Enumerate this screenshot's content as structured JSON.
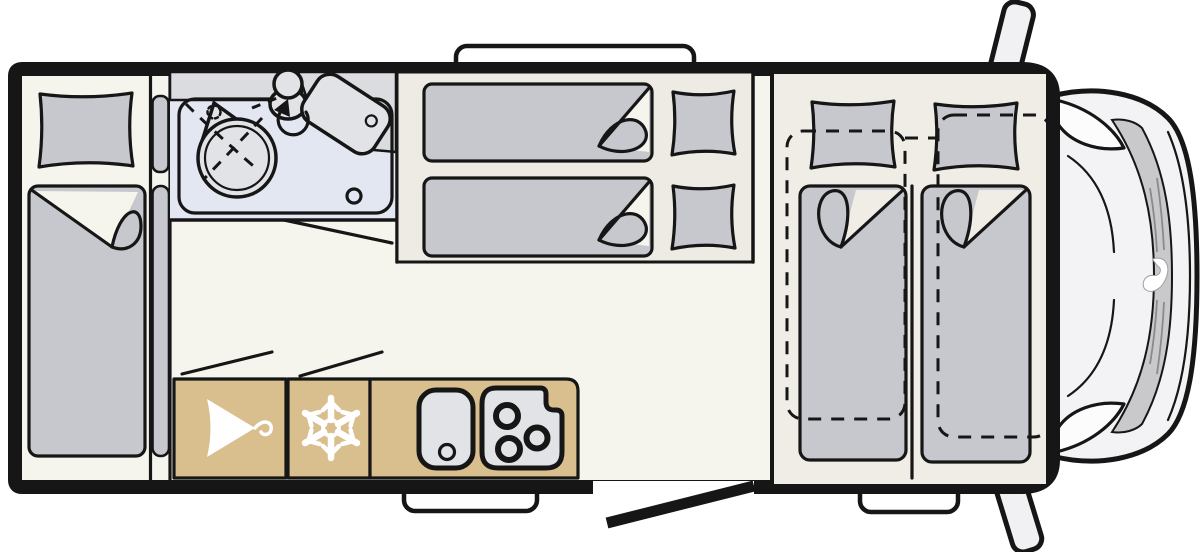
{
  "page": {
    "title": "Motorhome floor plan, top view",
    "background": "#ffffff"
  },
  "colors": {
    "outline": "#161616",
    "wall": "#161616",
    "floor": "#f5f4ed",
    "platform": "#edebe3",
    "bedroom_floor": "#efede5",
    "mattress": "#c6c8cd",
    "bathroom_floor": "#e3e7f2",
    "fixture": "#e2e3e6",
    "counter_gray": "#dbdcdf",
    "cabinet_tan": "#d9be8e",
    "icon": "#ffffff",
    "cab_body": "#f3f3f5",
    "hood_band": "#c9c9cc",
    "vent": "#8a8a8e",
    "mirror": "#f1f1f3"
  },
  "areas": [
    {
      "id": "rear-bedroom",
      "name": "rear bed with pillow and folded duvet"
    },
    {
      "id": "bathroom",
      "name": "washroom with shower, washbasin and toilet"
    },
    {
      "id": "middle-bedroom",
      "name": "two transverse single beds"
    },
    {
      "id": "kitchen",
      "name": "wardrobe, refrigerator and kitchen block"
    },
    {
      "id": "front-bedroom",
      "name": "two lengthwise single beds with dashed extension outline"
    },
    {
      "id": "cab",
      "name": "driver cab with mirrors"
    }
  ],
  "icons": [
    {
      "name": "hanger-icon",
      "meaning": "wardrobe"
    },
    {
      "name": "snowflake-icon",
      "meaning": "refrigerator"
    },
    {
      "name": "sink-icon",
      "meaning": "kitchen sink with drain"
    },
    {
      "name": "hob-icon",
      "meaning": "three burner hob"
    },
    {
      "name": "shower-icon",
      "meaning": "shower head and curtain"
    },
    {
      "name": "toilet-icon",
      "meaning": "toilet"
    },
    {
      "name": "washbasin-icon",
      "meaning": "round washbasin"
    },
    {
      "name": "door-swing-icon",
      "meaning": "open door indication"
    },
    {
      "name": "brand-logo-icon",
      "meaning": "manufacturer logo on hood"
    }
  ]
}
